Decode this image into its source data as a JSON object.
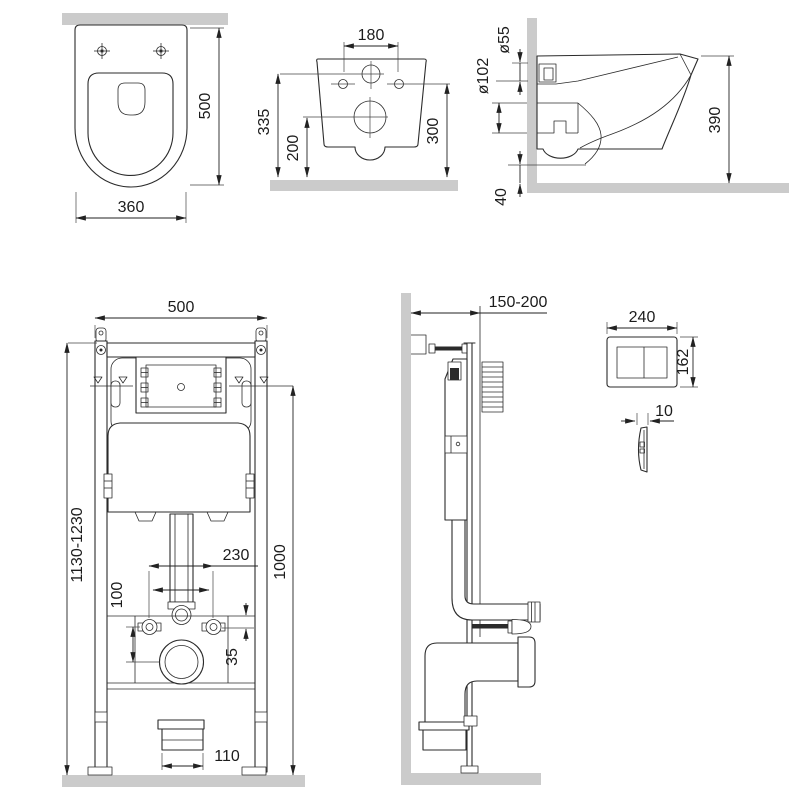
{
  "drawing": {
    "title": "wall-hung-toilet-installation-dimensions",
    "colors": {
      "line": "#2b2b2b",
      "wall": "#cbcbcb",
      "background": "#ffffff"
    },
    "views": {
      "toilet_top": {
        "label": "toilet top view",
        "dims": {
          "height": "500",
          "width": "360"
        }
      },
      "toilet_rear": {
        "label": "toilet rear view",
        "dims": {
          "bolt_spacing": "180",
          "flush_height": "335",
          "drain_height": "200",
          "bolt_height": "300"
        }
      },
      "toilet_side": {
        "label": "toilet side view",
        "dims": {
          "flush_diameter": "ø55",
          "outlet_diameter": "ø102",
          "body_height": "390",
          "floor_clearance": "40"
        }
      },
      "frame_front": {
        "label": "installation frame front view",
        "dims": {
          "frame_width": "500",
          "frame_height": "1130-1230",
          "flush_pipe_height": "1000",
          "stud_spacing": "230",
          "drain_offset": "100",
          "stud_offset": "35",
          "outlet_width": "110"
        }
      },
      "frame_side": {
        "label": "installation frame side view",
        "dims": {
          "install_depth": "150-200"
        }
      },
      "flush_plate": {
        "label": "flush plate",
        "dims": {
          "width": "240",
          "height": "162",
          "thickness": "10"
        }
      }
    }
  }
}
